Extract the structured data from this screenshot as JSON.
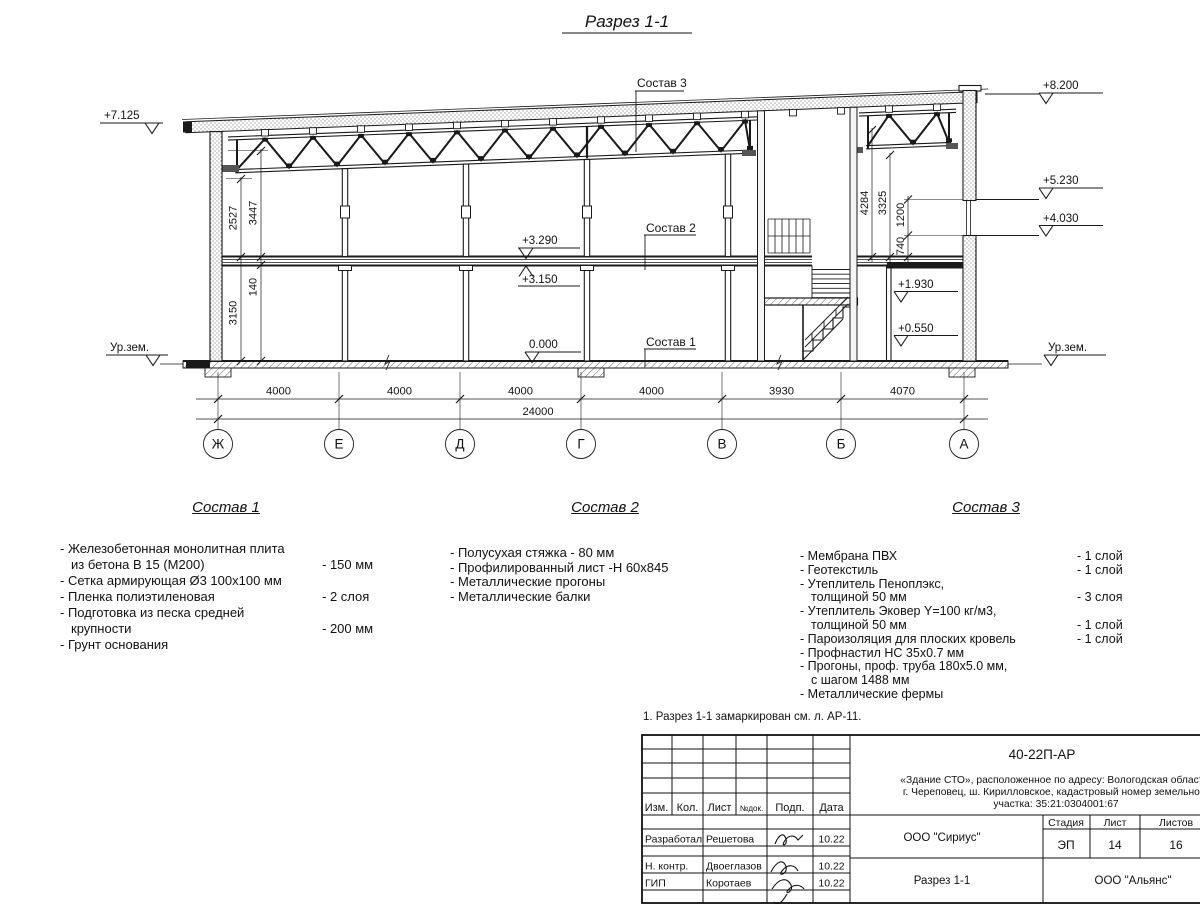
{
  "page": {
    "background": "#ffffff",
    "line_color": "#1a1a1a"
  },
  "drawing": {
    "title": "Разрез 1-1",
    "elevation_marks": {
      "roof_left": "+7.125",
      "ground_left": "Ур.зем.",
      "parapet": "+8.200",
      "window_head": "+5.230",
      "window_sill": "+4.030",
      "ground_right": "Ур.зем.",
      "floor_finish": "+3.290",
      "floor_slab": "+3.150",
      "zero": "0.000",
      "stair_landing": "+1.930",
      "platform": "+0.550"
    },
    "dims_left": {
      "truss_clear": "2527",
      "floor_to_chord": "3447",
      "slab_thickness": "140",
      "ground_floor_height": "3150"
    },
    "dims_right": {
      "d1": "4284",
      "d2": "3325",
      "d3": "1200",
      "d4": "740"
    },
    "leader_labels": {
      "sostav1": "Состав 1",
      "sostav2": "Состав 2",
      "sostav3": "Состав 3"
    },
    "axes": [
      "Ж",
      "Е",
      "Д",
      "Г",
      "В",
      "Б",
      "А"
    ],
    "bay_dims": [
      "4000",
      "4000",
      "4000",
      "4000",
      "3930",
      "4070"
    ],
    "total_dim": "24000"
  },
  "compositions": [
    {
      "title": "Состав 1",
      "rows": [
        {
          "t": "- Железобетонная  монолитная плита",
          "v": "",
          "i": 0
        },
        {
          "t": "из бетона В 15 (М200)",
          "v": "- 150 мм",
          "i": 1
        },
        {
          "t": "- Сетка армирующая Ø3 100х100 мм",
          "v": "",
          "i": 0
        },
        {
          "t": "- Пленка полиэтиленовая",
          "v": "-  2 слоя",
          "i": 0
        },
        {
          "t": "- Подготовка из песка средней",
          "v": "",
          "i": 0
        },
        {
          "t": "крупности",
          "v": "- 200 мм",
          "i": 1
        },
        {
          "t": "- Грунт основания",
          "v": "",
          "i": 0
        }
      ]
    },
    {
      "title": "Состав 2",
      "rows": [
        {
          "t": "- Полусухая стяжка - 80 мм",
          "v": "",
          "i": 0
        },
        {
          "t": "- Профилированный лист -Н 60х845",
          "v": "",
          "i": 0
        },
        {
          "t": "-  Металлические прогоны",
          "v": "",
          "i": 0
        },
        {
          "t": "- Металлические балки",
          "v": "",
          "i": 0
        }
      ]
    },
    {
      "title": "Состав 3",
      "rows": [
        {
          "t": "- Мембрана ПВХ",
          "v": "- 1 слой",
          "i": 0
        },
        {
          "t": "- Геотекстиль",
          "v": "- 1 слой",
          "i": 0
        },
        {
          "t": "- Утеплитель Пеноплэкс,",
          "v": "",
          "i": 0
        },
        {
          "t": "толщиной 50 мм",
          "v": "- 3 слоя",
          "i": 1
        },
        {
          "t": "- Утеплитель Эковер Y=100 кг/м3,",
          "v": "",
          "i": 0
        },
        {
          "t": "толщиной 50 мм",
          "v": "- 1 слой",
          "i": 1
        },
        {
          "t": "- Пароизоляция для плоских кровель",
          "v": "- 1 слой",
          "i": 0
        },
        {
          "t": "- Профнастил НС 35х0.7 мм",
          "v": "",
          "i": 0
        },
        {
          "t": "- Прогоны, проф. труба 180х5.0 мм,",
          "v": "",
          "i": 0
        },
        {
          "t": "с шагом 1488 мм",
          "v": "",
          "i": 1
        },
        {
          "t": "- Металлические фермы",
          "v": "",
          "i": 0
        }
      ]
    }
  ],
  "note": "1. Разрез 1-1 замаркирован см. л. АР-11.",
  "titleblock": {
    "doc_number": "40-22П-АР",
    "project_lines": [
      "«Здание СТО», расположенное по адресу: Вологодская область,",
      "г. Череповец, ш. Кирилловское, кадастровый номер земельного",
      "участка: 35:21:0304001:67"
    ],
    "header_cols": [
      "Изм.",
      "Кол.",
      "Лист",
      "№док.",
      "Подп.",
      "Дата"
    ],
    "sign_rows": [
      {
        "role": "Разработал",
        "name": "Решетова",
        "date": "10.22"
      },
      {
        "role": "Н. контр.",
        "name": "Двоеглазов",
        "date": "10.22"
      },
      {
        "role": "ГИП",
        "name": "Коротаев",
        "date": "10.22"
      }
    ],
    "design_org": "ООО \"Сириус\"",
    "sheet_name": "Разрез 1-1",
    "customer_org": "ООО \"Альянс\"",
    "stage_label": "Стадия",
    "sheet_label": "Лист",
    "sheets_label": "Листов",
    "stage": "ЭП",
    "sheet_number": "14",
    "sheets_total": "16"
  }
}
